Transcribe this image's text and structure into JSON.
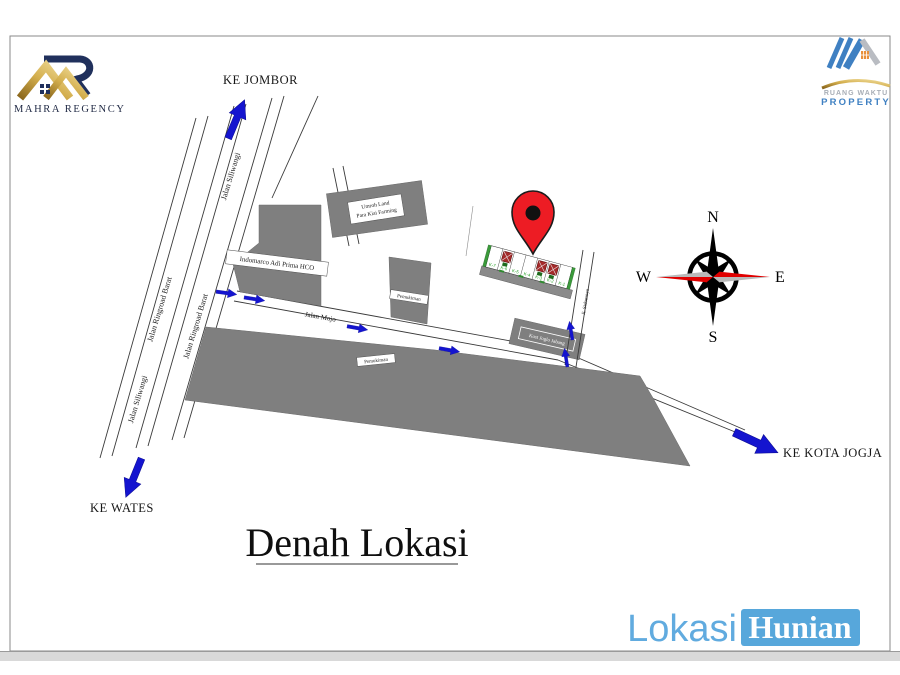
{
  "branding": {
    "mahra_label": "MAHRA REGENCY",
    "ruang_waktu_line1": "RUANG WAKTU",
    "ruang_waktu_line2": "PROPERTY"
  },
  "title": {
    "text": "Denah Lokasi"
  },
  "watermark": {
    "lokasi": "Lokasi",
    "hunian": "Hunian"
  },
  "directions": {
    "ke_jombor": "KE JOMBOR",
    "ke_wates": "KE WATES",
    "ke_kota_jogja": "KE KOTA JOGJA"
  },
  "roads": {
    "siliwangi_top": "Jalan Siliwangi",
    "siliwangi_bottom": "Jalan Siliwangi",
    "ringroad_barat_1": "Jalan Ringroad Barat",
    "ringroad_barat_2": "Jalan Ringroad Barat",
    "mojo": "Jalan Mojo",
    "sidomoyo": "Jl. Sidomoyo"
  },
  "places": {
    "indomarco": "Indomarco Adi Prima HCO",
    "umroh_line1": "Umroh Land",
    "umroh_line2": "Para Kiai Farming",
    "pemukiman_north": "Pemukiman",
    "pemukiman_south": "Pemukiman",
    "kost": "Kost Joglo Jabang"
  },
  "compass": {
    "n": "N",
    "e": "E",
    "s": "S",
    "w": "W"
  },
  "site_plan": {
    "plots": [
      {
        "label": "K-7",
        "sold": false
      },
      {
        "label": "K-6",
        "sold": true
      },
      {
        "label": "K-5",
        "sold": false
      },
      {
        "label": "K-4",
        "sold": false
      },
      {
        "label": "K-3",
        "sold": true
      },
      {
        "label": "K-2",
        "sold": true
      },
      {
        "label": "K-1",
        "sold": false
      }
    ]
  },
  "colors": {
    "building_gray": "#7f7f7f",
    "arrow_blue": "#1414cf",
    "pin_red": "#ed1c24",
    "compass_red": "#e00000",
    "watermark_blue": "#57a7db",
    "gold": "#c9a24a",
    "navy": "#1f2c55",
    "agency_blue": "#3f80c2",
    "site_green": "#2e8b2e"
  }
}
